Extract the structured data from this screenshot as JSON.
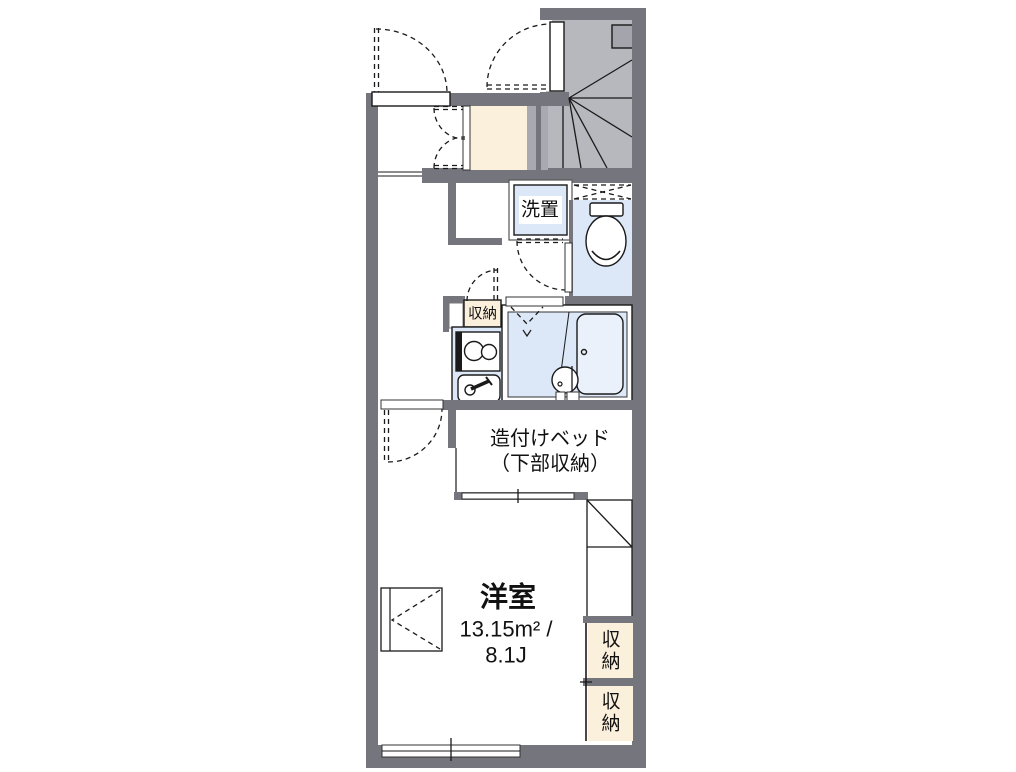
{
  "floor_plan": {
    "type": "apartment-floor-plan",
    "rooms": {
      "main_room": {
        "name": "洋室",
        "area_line1": "13.15m² /",
        "area_line2": "8.1J"
      },
      "built_in_bed": {
        "line1": "造付けベッド",
        "line2": "（下部収納）"
      },
      "washer_space": {
        "label": "洗置"
      },
      "kitchen_storage": {
        "label": "収納"
      },
      "right_storage_upper": {
        "char_top": "収",
        "char_bottom": "納"
      },
      "right_storage_lower": {
        "char_top": "収",
        "char_bottom": "納"
      }
    },
    "colors": {
      "wall": "#75757d",
      "stair_gray": "#b7b7be",
      "water_blue": "#dce7f7",
      "storage_cream": "#fbf0dc",
      "line": "#1a1a1a",
      "background": "#ffffff"
    }
  }
}
